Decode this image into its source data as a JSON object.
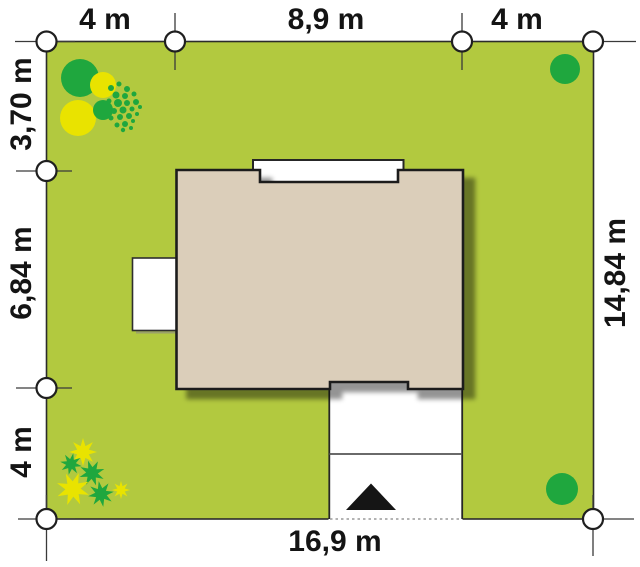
{
  "plan": {
    "dimensions": {
      "top": [
        "4 m",
        "8,9 m",
        "4 m"
      ],
      "left": [
        "3,70 m",
        "6,84 m",
        "4 m"
      ],
      "right": [
        "14,84 m"
      ],
      "bottom": [
        "16,9 m"
      ]
    },
    "colors": {
      "lawn": "#b2c93f",
      "lot_border": "#2b2b2b",
      "house_fill": "#dbceba",
      "house_outline": "#1f1f1f",
      "white": "#ffffff",
      "tree_green": "#1fa73e",
      "bush_yellow": "#e9e300",
      "divider_gray": "#555555",
      "arrow_black": "#151515",
      "marker_line": "#3a3a3a",
      "text": "#141414"
    }
  }
}
